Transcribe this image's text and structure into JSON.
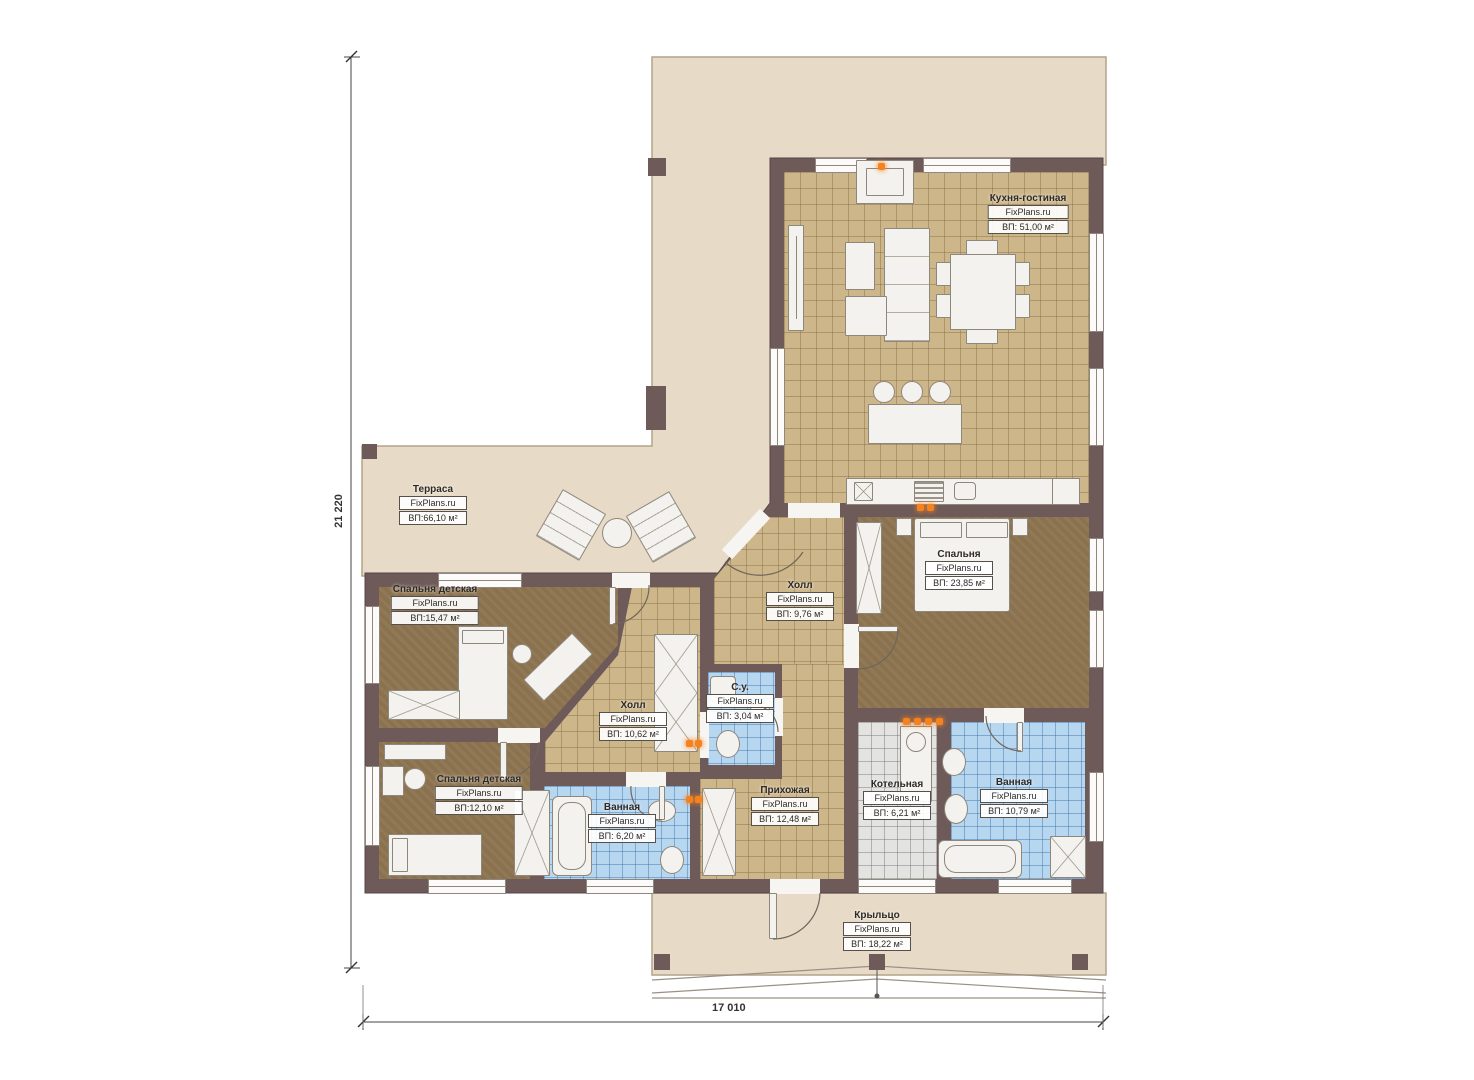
{
  "dimensions": {
    "vertical": "21 220",
    "horizontal": "17 010"
  },
  "rooms": [
    {
      "name": "Терраса",
      "brand": "FixPlans.ru",
      "area": "ВП:66,10 м²"
    },
    {
      "name": "Кухня-гостиная",
      "brand": "FixPlans.ru",
      "area": "ВП: 51,00 м²"
    },
    {
      "name": "Спальня",
      "brand": "FixPlans.ru",
      "area": "ВП: 23,85 м²"
    },
    {
      "name": "Холл",
      "brand": "FixPlans.ru",
      "area": "ВП: 9,76 м²"
    },
    {
      "name": "Спальня детская",
      "brand": "FixPlans.ru",
      "area": "ВП:15,47 м²"
    },
    {
      "name": "Холл",
      "brand": "FixPlans.ru",
      "area": "ВП: 10,62 м²"
    },
    {
      "name": "С.у.",
      "brand": "FixPlans.ru",
      "area": "ВП: 3,04 м²"
    },
    {
      "name": "Спальня детская",
      "brand": "FixPlans.ru",
      "area": "ВП:12,10 м²"
    },
    {
      "name": "Ванная",
      "brand": "FixPlans.ru",
      "area": "ВП: 6,20 м²"
    },
    {
      "name": "Прихожая",
      "brand": "FixPlans.ru",
      "area": "ВП: 12,48 м²"
    },
    {
      "name": "Котельная",
      "brand": "FixPlans.ru",
      "area": "ВП: 6,21 м²"
    },
    {
      "name": "Ванная",
      "brand": "FixPlans.ru",
      "area": "ВП: 10,79 м²"
    },
    {
      "name": "Крыльцо",
      "brand": "FixPlans.ru",
      "area": "ВП: 18,22 м²"
    }
  ],
  "colors": {
    "wall": "#6e5a58",
    "terrace_floor": "#e7dbc7",
    "tile_floor": "#cdb68a",
    "carpet_floor": "#8b724e",
    "bath_tile": "#b7d7f0",
    "utility_tile": "#e3e3e1",
    "furniture": "#f4f2ee",
    "accent_orange": "#f5821f"
  }
}
